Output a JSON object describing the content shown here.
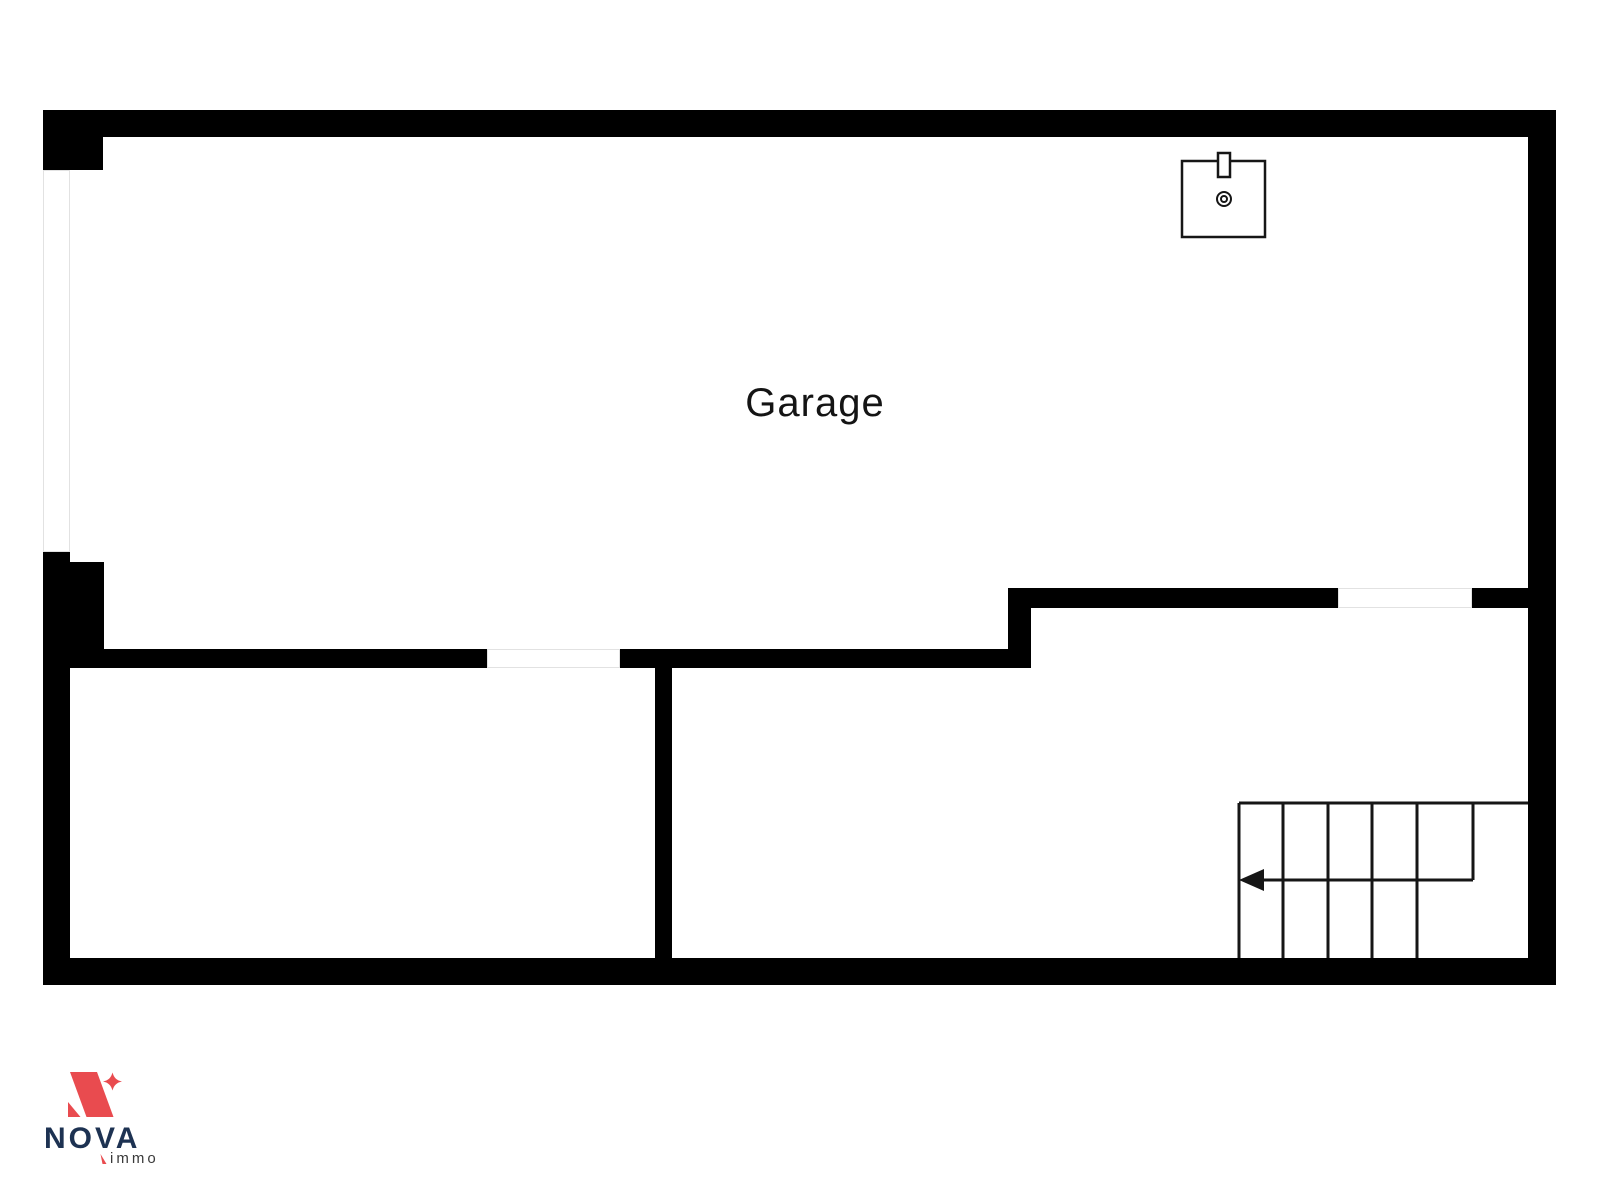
{
  "page": {
    "background": "#ffffff",
    "width_px": 1600,
    "height_px": 1200
  },
  "floorplan": {
    "room_label": "Garage",
    "wall_color": "#000000",
    "line_color": "#161616",
    "opening_outline_color": "#e2e2e2",
    "openings": [
      {
        "name": "window-opening",
        "wall": "left-exterior"
      },
      {
        "name": "door-opening",
        "wall": "lower-interior"
      },
      {
        "name": "window-opening",
        "wall": "upper-interior-right"
      }
    ],
    "fixtures": [
      {
        "name": "sink-icon",
        "location": "top-right-of-garage"
      },
      {
        "name": "stairs",
        "upper_treads": 5,
        "lower_treads": 4,
        "direction_arrow": "left"
      }
    ]
  },
  "branding": {
    "logo_name": "NOVA",
    "logo_sub": "immo",
    "accent_red": "#e94b4f",
    "navy": "#1d3252",
    "sub_color": "#3a3a3a"
  }
}
